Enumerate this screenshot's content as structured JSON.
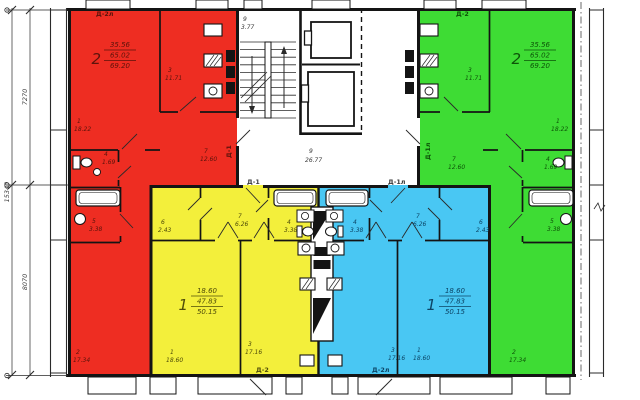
{
  "colors": {
    "red": "#ee2d22",
    "green": "#3edc34",
    "yellow": "#f3ef3b",
    "blue": "#49c7f3",
    "wall": "#141414",
    "paper": "#ffffff"
  },
  "dimensions": {
    "upper": "7270",
    "lower": "8070",
    "overall": "15340"
  },
  "core": {
    "stair_num": "9",
    "stair_area": "3.77",
    "corridor_num": "9",
    "corridor_area": "26.77"
  },
  "doors": {
    "red_top": "Д-2л",
    "green_top": "Д-2",
    "red_entry": "Д-1",
    "green_entry": "Д-1л",
    "yellow_entry": "Д-1",
    "blue_entry": "Д-1л",
    "yellow_balcony": "Д-2",
    "blue_balcony": "Д-2л"
  },
  "apartments": {
    "red": {
      "type_label": "2",
      "stats": {
        "living": "35.56",
        "apartment": "65.02",
        "total": "69.20"
      },
      "rooms": [
        {
          "num": "1",
          "area": "18.22"
        },
        {
          "num": "3",
          "area": "11.71"
        },
        {
          "num": "4",
          "area": "1.69"
        },
        {
          "num": "7",
          "area": "12.60"
        },
        {
          "num": "5",
          "area": "3.38"
        },
        {
          "num": "2",
          "area": "17.34"
        }
      ]
    },
    "green": {
      "type_label": "2",
      "stats": {
        "living": "35.56",
        "apartment": "65.02",
        "total": "69.20"
      },
      "rooms": [
        {
          "num": "3",
          "area": "11.71"
        },
        {
          "num": "1",
          "area": "18.22"
        },
        {
          "num": "7",
          "area": "12.60"
        },
        {
          "num": "4",
          "area": "1.69"
        },
        {
          "num": "5",
          "area": "3.38"
        },
        {
          "num": "2",
          "area": "17.34"
        }
      ]
    },
    "yellow": {
      "type_label": "1",
      "stats": {
        "living": "18.60",
        "apartment": "47.83",
        "total": "50.15"
      },
      "rooms": [
        {
          "num": "6",
          "area": "2.43"
        },
        {
          "num": "7",
          "area": "6.26"
        },
        {
          "num": "4",
          "area": "3.38"
        },
        {
          "num": "1",
          "area": "18.60"
        },
        {
          "num": "3",
          "area": "17.16"
        }
      ]
    },
    "blue": {
      "type_label": "1",
      "stats": {
        "living": "18.60",
        "apartment": "47.83",
        "total": "50.15"
      },
      "rooms": [
        {
          "num": "4",
          "area": "3.38"
        },
        {
          "num": "7",
          "area": "6.26"
        },
        {
          "num": "6",
          "area": "2.43"
        },
        {
          "num": "3",
          "area": "17.16"
        },
        {
          "num": "1",
          "area": "18.60"
        }
      ]
    }
  }
}
